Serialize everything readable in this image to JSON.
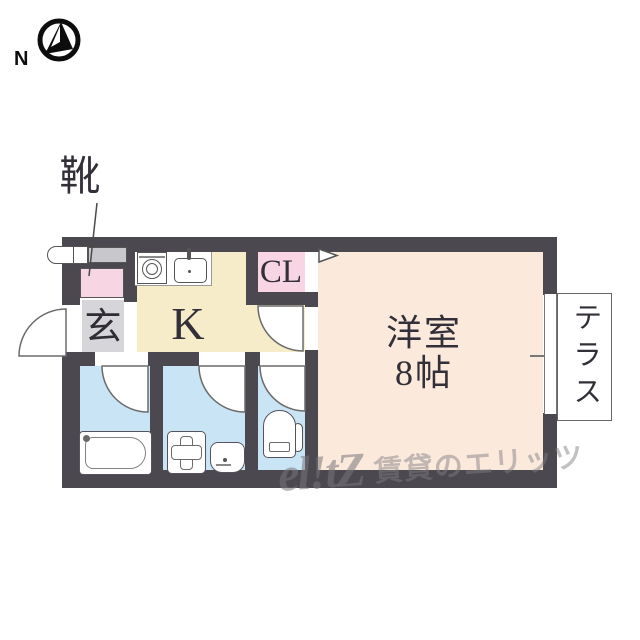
{
  "compass": {
    "label": "N"
  },
  "annotations": {
    "shoe_callout": "靴"
  },
  "rooms": {
    "genkan": {
      "label": "玄"
    },
    "kitchen": {
      "label": "K"
    },
    "closet": {
      "label": "CL"
    },
    "western_room": {
      "name": "洋室",
      "size": "8帖"
    },
    "terrace": {
      "label": "テラス"
    }
  },
  "watermark": {
    "logo": "el!tZ",
    "text": "賃貸のエリッツ"
  },
  "icons": [
    "compass-icon",
    "stove-icon",
    "kitchen-sink-icon",
    "bathtub-icon",
    "washing-machine-pan-icon",
    "washbasin-icon",
    "toilet-icon",
    "entrance-door-arc",
    "room-door-arc",
    "bathroom-door-arc",
    "washroom-door-arc",
    "toilet-door-arc",
    "closet-door-marker",
    "terrace-window-icon"
  ],
  "colors": {
    "wall": "#4b4850",
    "kitchen_floor": "#f7ecc9",
    "room_floor": "#fbe9dc",
    "wet_area_floor": "#c9e4f5",
    "closet_pink": "#f8d5e3",
    "genkan_gray": "#d6d5d9",
    "watermark_gray": "#8a8a8a"
  }
}
